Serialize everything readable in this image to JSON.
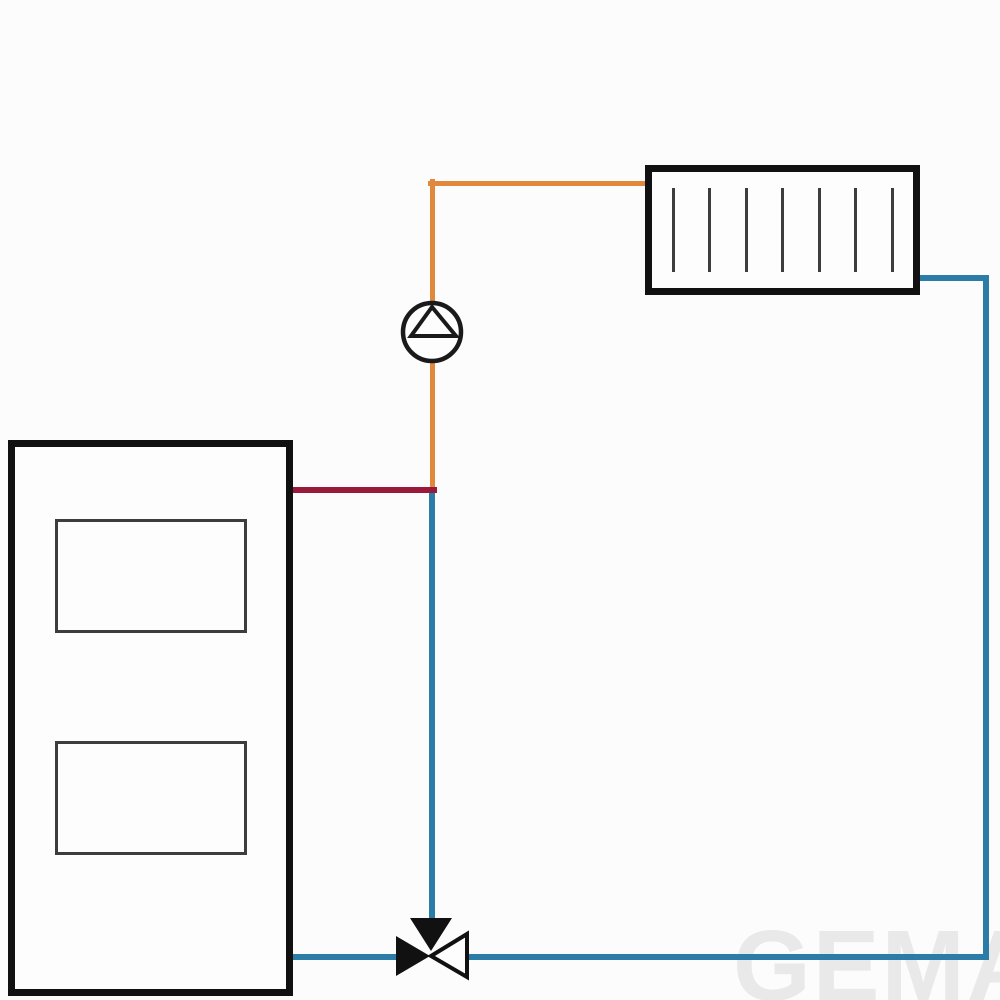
{
  "diagram": {
    "kind": "hydronic-heating-system-schematic",
    "colors": {
      "background": "#fcfcfc",
      "component_fill": "#fdfdfd",
      "outline": "#111111",
      "detail_line": "#3d3d3d",
      "symbol_stroke": "#1a1a1a",
      "flow_pipe": "#e0883c",
      "boiler_flow_pipe": "#9a1a3c",
      "return_pipe": "#2b7ca6",
      "valve_fill": "#111111",
      "watermark": "#e9e9e9"
    },
    "components": {
      "boiler": {
        "x": 8,
        "y": 440,
        "width": 285,
        "height": 556,
        "border_width": 7,
        "panels": [
          {
            "x": 55,
            "y": 519,
            "width": 192,
            "height": 114,
            "border_width": 3
          },
          {
            "x": 55,
            "y": 741,
            "width": 192,
            "height": 114,
            "border_width": 3
          }
        ]
      },
      "radiator": {
        "x": 645,
        "y": 165,
        "width": 275,
        "height": 130,
        "border_width": 7,
        "fins": {
          "count": 7,
          "inset_x": 28,
          "top_offset": 23,
          "height": 84,
          "width": 3
        }
      },
      "pump": {
        "cx": 432,
        "cy": 332,
        "r": 29,
        "stroke_width": 4.5,
        "impeller_triangle": [
          [
            432,
            307
          ],
          [
            411,
            336
          ],
          [
            456,
            336
          ]
        ],
        "triangle_stroke_width": 4
      },
      "mixing_valve": {
        "top_triangle": [
          [
            410,
            918
          ],
          [
            452,
            918
          ],
          [
            431,
            951
          ]
        ],
        "left_triangle": [
          [
            396,
            936
          ],
          [
            396,
            976
          ],
          [
            430,
            956
          ]
        ],
        "right_triangle": [
          [
            467,
            934
          ],
          [
            467,
            977
          ],
          [
            431,
            956
          ]
        ],
        "stroke_width": 4
      }
    },
    "pipes": [
      {
        "name": "flow-riser",
        "color": "flow_pipe",
        "x1": 432,
        "y1": 181,
        "x2": 432,
        "y2": 490,
        "width": 5
      },
      {
        "name": "flow-to-radiator",
        "color": "flow_pipe",
        "x1": 430,
        "y1": 183,
        "x2": 649,
        "y2": 183,
        "width": 5
      },
      {
        "name": "return-mid-riser",
        "color": "return_pipe",
        "x1": 432,
        "y1": 490,
        "x2": 432,
        "y2": 923,
        "width": 6
      },
      {
        "name": "boiler-flow",
        "color": "boiler_flow_pipe",
        "x1": 291,
        "y1": 490,
        "x2": 434,
        "y2": 490,
        "width": 6
      },
      {
        "name": "return-bottom-left",
        "color": "return_pipe",
        "x1": 291,
        "y1": 957,
        "x2": 399,
        "y2": 957,
        "width": 6
      },
      {
        "name": "return-bottom-right",
        "color": "return_pipe",
        "x1": 463,
        "y1": 957,
        "x2": 986,
        "y2": 957,
        "width": 6
      },
      {
        "name": "return-right-riser",
        "color": "return_pipe",
        "x1": 986,
        "y1": 278,
        "x2": 986,
        "y2": 957,
        "width": 6
      },
      {
        "name": "radiator-outlet",
        "color": "return_pipe",
        "x1": 917,
        "y1": 278,
        "x2": 986,
        "y2": 278,
        "width": 6
      }
    ],
    "watermark": {
      "text": "GEMA",
      "x": 733,
      "y": 916,
      "font_size": 100
    }
  }
}
